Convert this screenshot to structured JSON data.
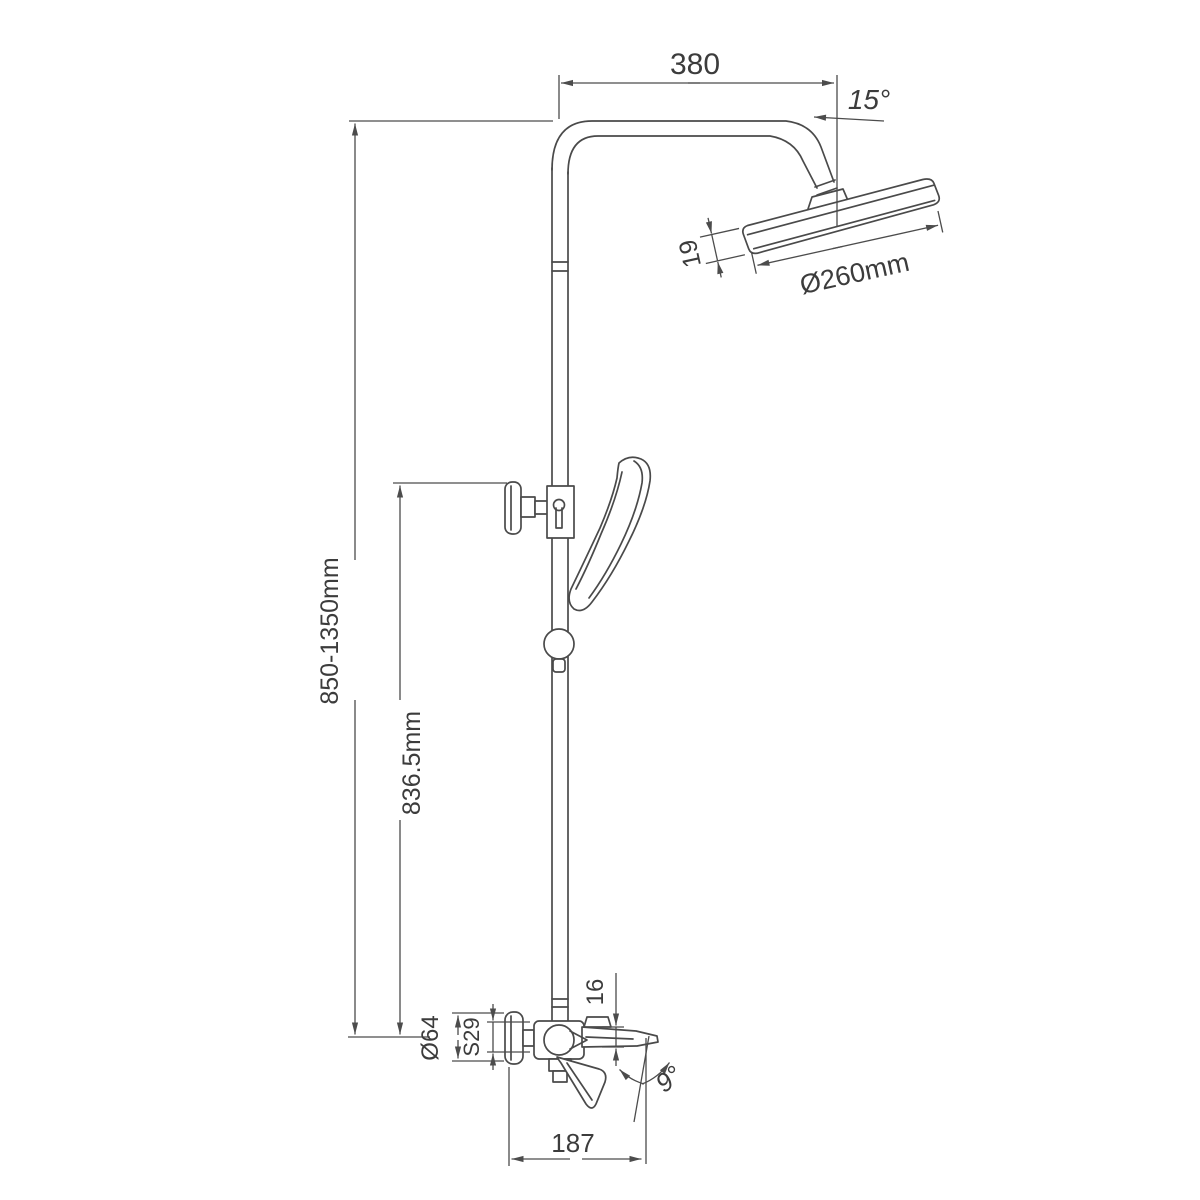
{
  "drawing": {
    "background": "#ffffff",
    "line_color": "#4a4a4a",
    "text_color": "#3c3c3c",
    "labels": {
      "top_arm_width": "380",
      "head_tilt_angle": "15°",
      "head_diameter": "Ø260mm",
      "head_thickness": "19",
      "total_height_range": "850-1350mm",
      "slide_bar_height": "836.5mm",
      "escutcheon_diameter": "Ø64",
      "nut_width": "S29",
      "spout_drop": "16",
      "spout_angle": "9°",
      "spout_reach": "187"
    }
  }
}
